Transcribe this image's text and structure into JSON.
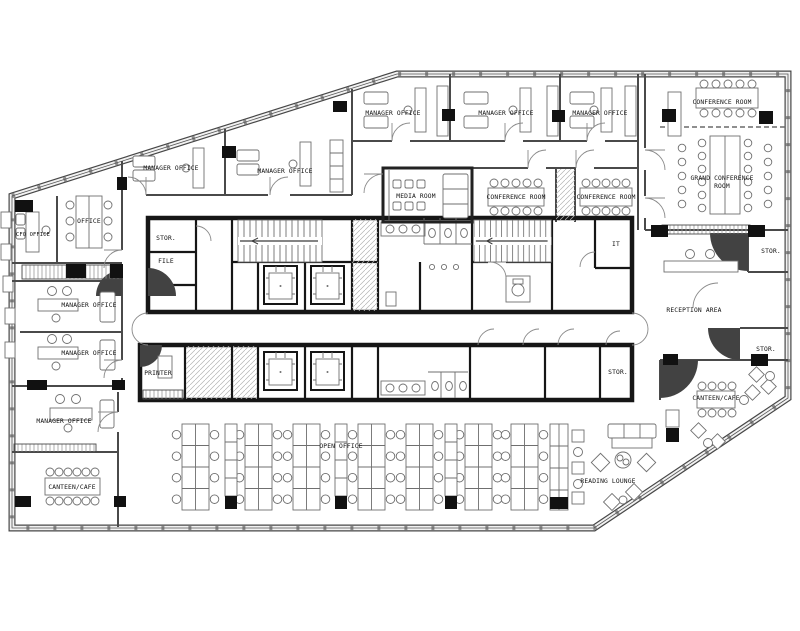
{
  "colors": {
    "wall_dark": "#161616",
    "wall_gray": "#4a4a4a",
    "furniture_line": "#6f6f6f",
    "column_black": "#111111",
    "corner_wedge": "#424242",
    "background": "#ffffff"
  },
  "labels": {
    "manager_office_1": "MANAGER OFFICE",
    "manager_office_2": "MANAGER OFFICE",
    "manager_office_3": "MANAGER OFFICE",
    "manager_office_4": "MANAGER OFFICE",
    "manager_office_5": "MANAGER OFFICE",
    "conference_room_top": "CONFERENCE ROOM",
    "grand_conference_line1": "GRAND CONFERENCE",
    "grand_conference_line2": "ROOM",
    "cfo_office": "CFO OFFICE",
    "office": "OFFICE",
    "media_room": "MEDIA ROOM",
    "conference_room_a": "CONFERENCE ROOM",
    "conference_room_b": "CONFERENCE ROOM",
    "stor_core_left": "STOR.",
    "file_room": "FILE",
    "it_room": "IT",
    "stor_top_right": "STOR.",
    "reception_area": "RECEPTION AREA",
    "stor_right": "STOR.",
    "stor_core_right": "STOR.",
    "printer_room": "PRINTER",
    "manager_office_left_1": "MANAGER OFFICE",
    "manager_office_left_2": "MANAGER OFFICE",
    "manager_office_bottom": "MANAGER OFFICE",
    "canteen_cafe_left": "CANTEEN/CAFE",
    "open_office": "OPEN OFFICE",
    "canteen_cafe_right": "CANTEEN/CAFE",
    "reading_lounge": "READING LOUNGE"
  }
}
